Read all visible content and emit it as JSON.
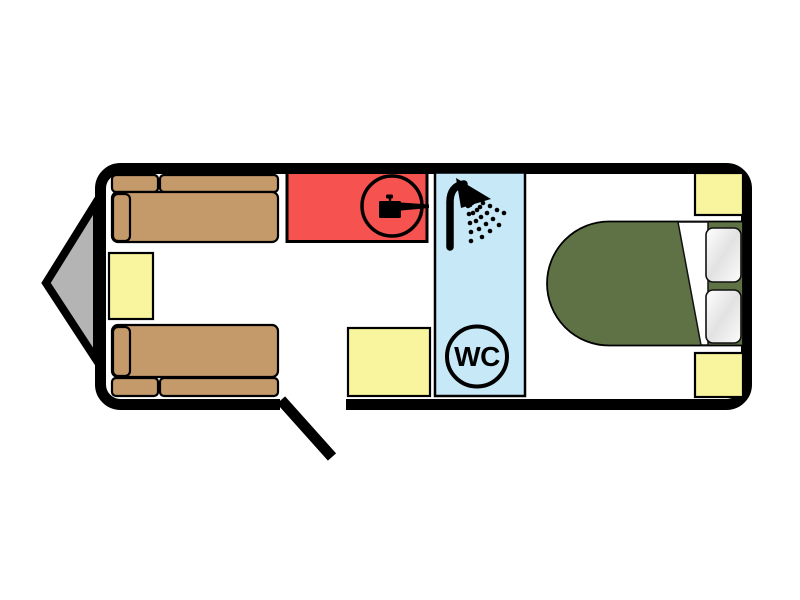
{
  "floorplan": {
    "labels": {
      "wc": "WC"
    },
    "colors": {
      "wall": "#000000",
      "floor": "#ffffff",
      "hitch_gray": "#b4b4b4",
      "sofa_tan": "#c49a6b",
      "furniture_yellow": "#f9f49e",
      "kitchen_red": "#f55250",
      "bathroom_blue": "#c7e9f7",
      "bed_green": "#5e7246",
      "icon_black": "#000000"
    },
    "icons": {
      "cooking_pot_icon": "saucepan-in-circle",
      "shower_icon": "shower-head-with-spray",
      "wc_icon": "wc-text-in-circle",
      "hitch_icon": "tow-hitch-triangle",
      "door_icon": "open-door-swing-line"
    }
  }
}
